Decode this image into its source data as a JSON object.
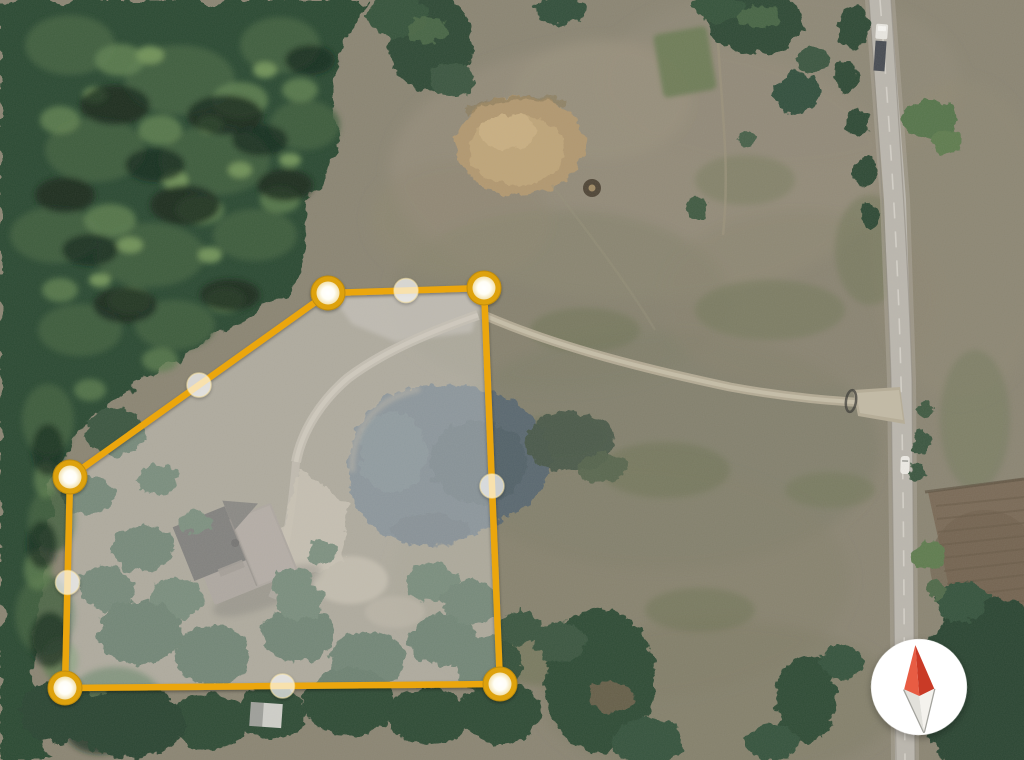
{
  "app": {
    "type": "satellite-map-view",
    "description": "Aerial imagery with editable property parcel boundary overlay"
  },
  "canvas": {
    "width": 1024,
    "height": 760
  },
  "boundary": {
    "shape": "5-sided parcel polygon",
    "stroke_color": "#EBA60F",
    "stroke_width": 6.5,
    "fill_color": "rgba(255,255,255,0.30)",
    "vertices": [
      [
        328,
        293
      ],
      [
        484,
        288
      ],
      [
        500,
        684
      ],
      [
        65,
        688
      ],
      [
        70,
        477
      ]
    ],
    "vertex_marker": {
      "outer_r": 17,
      "inner_r": 11.5,
      "ring_color": "#DEA211",
      "edge_color": "#C08C08"
    },
    "midpoint_marker": {
      "r": 12,
      "fill": "rgba(255,255,255,0.66)",
      "stroke": "rgba(250,230,170,0.55)"
    }
  },
  "compass": {
    "cx": 919,
    "cy": 687,
    "r": 48,
    "rotation": -5,
    "bg": "#FFFFFF",
    "north_left": "#E85C43",
    "north_right": "#C93A26",
    "south_left": "#E2E1DB",
    "south_right": "#F4F2ED",
    "south_outline": "#A2A29C"
  },
  "vehicles": [
    {
      "kind": "semi-truck",
      "x": 881,
      "y": 42,
      "cab_color": "#E9E7E1",
      "trailer_color": "#474B52"
    },
    {
      "kind": "car",
      "x": 905,
      "y": 465,
      "color": "#ECEAE4"
    }
  ],
  "features": {
    "field": {
      "label": "open pasture",
      "color": "#8B8573"
    },
    "forest": {
      "label": "dense woods west",
      "color": "#2C4833"
    },
    "pond": {
      "label": "pond",
      "color": "#5A6870",
      "center": [
        448,
        465
      ]
    },
    "house": {
      "label": "house with gray roof",
      "center": [
        240,
        555
      ],
      "roof_color": "#8A8177",
      "wing_color": "#4B4A46"
    },
    "driveway": {
      "label": "gravel driveway to road",
      "color": "#B6AD97"
    },
    "road": {
      "label": "two-lane road east",
      "color": "#BBB7AE"
    },
    "tilled_field": {
      "label": "tilled field southeast",
      "color": "#7A6A57"
    },
    "dirt_patch": {
      "label": "bare dirt patch north",
      "color": "#B29870",
      "center": [
        520,
        145
      ]
    },
    "garden": {
      "label": "garden plot",
      "color": "#6C7C54",
      "center": [
        684,
        62
      ]
    },
    "shed": {
      "label": "small outbuilding",
      "color": "#CFCFC9",
      "center": [
        266,
        715
      ]
    }
  }
}
